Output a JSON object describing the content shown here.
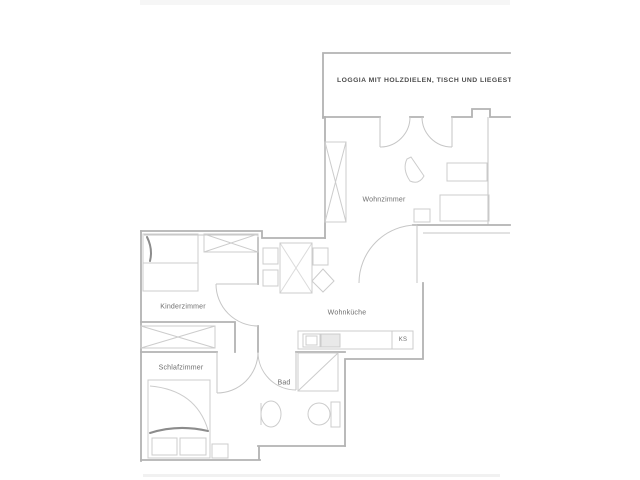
{
  "plan": {
    "annotation": "LOGGIA MIT HOLZDIELEN, TISCH UND LIEGESTUHL",
    "rooms": [
      {
        "id": "wohnzimmer",
        "label": "Wohnzimmer"
      },
      {
        "id": "wohnkueche",
        "label": "Wohnküche"
      },
      {
        "id": "kinderzimmer",
        "label": "Kinderzimmer"
      },
      {
        "id": "schlafzimmer",
        "label": "Schlafzimmer"
      },
      {
        "id": "bad",
        "label": "Bad"
      },
      {
        "id": "kuehlschrank",
        "label": "KS"
      }
    ],
    "colors": {
      "wall": "#b3b3b3",
      "door": "#c6c6c6",
      "furniture": "#cccccc",
      "label": "#6e6e6e",
      "annotation": "#4d4d4d",
      "accent_dark": "#8c8c8c",
      "photo_edge": "#f6f6f6"
    }
  }
}
